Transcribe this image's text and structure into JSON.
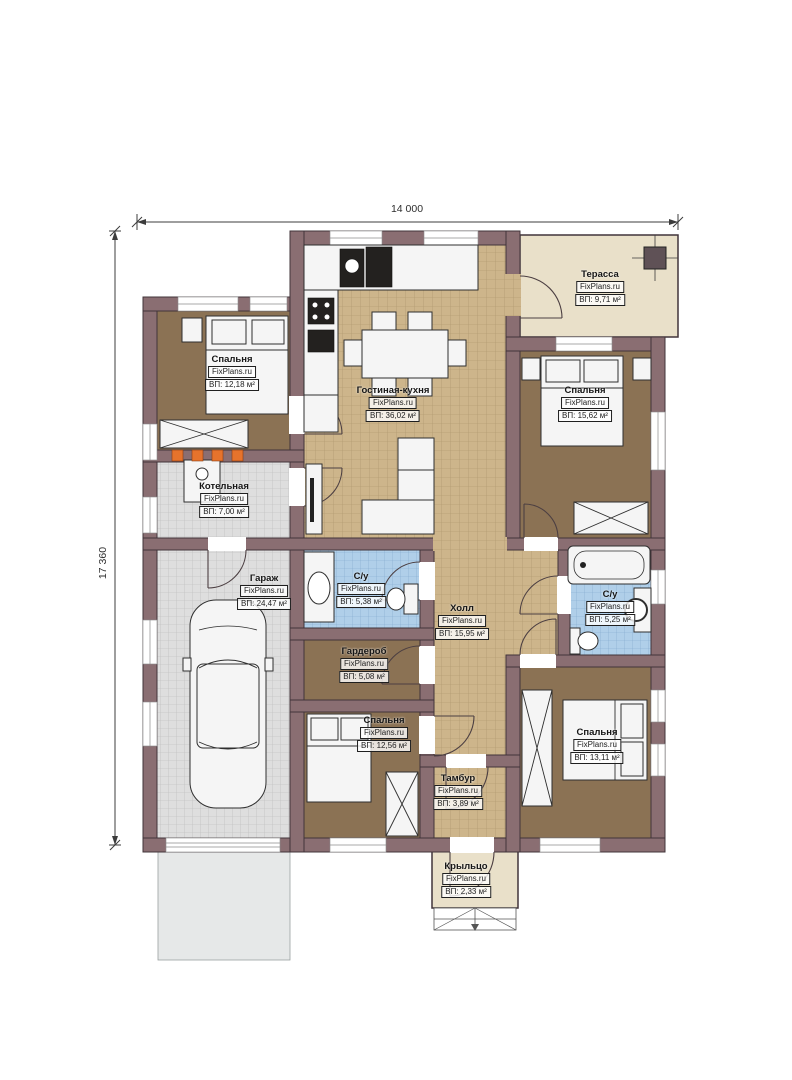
{
  "plan_title": "Одноэтажный дом — план этажа",
  "brand": "FixPlans.ru",
  "dimensions": {
    "width": "14 000",
    "height": "17 360"
  },
  "rooms": [
    {
      "name": "Спальня",
      "area": "ВП: 12,18 м²"
    },
    {
      "name": "Гостиная-кухня",
      "area": "ВП: 36,02 м²"
    },
    {
      "name": "Терасса",
      "area": "ВП: 9,71 м²"
    },
    {
      "name": "Спальня",
      "area": "ВП: 15,62 м²"
    },
    {
      "name": "Котельная",
      "area": "ВП: 7,00 м²"
    },
    {
      "name": "Гараж",
      "area": "ВП: 24,47 м²"
    },
    {
      "name": "С/у",
      "area": "ВП: 5,38 м²"
    },
    {
      "name": "Холл",
      "area": "ВП: 15,95 м²"
    },
    {
      "name": "С/у",
      "area": "ВП: 5,25 м²"
    },
    {
      "name": "Гардероб",
      "area": "ВП: 5,08 м²"
    },
    {
      "name": "Спальня",
      "area": "ВП: 12,56 м²"
    },
    {
      "name": "Спальня",
      "area": "ВП: 13,11 м²"
    },
    {
      "name": "Тамбур",
      "area": "ВП: 3,89 м²"
    },
    {
      "name": "Крыльцо",
      "area": "ВП: 2,33 м²"
    }
  ],
  "colors": {
    "wall": "#8a6e72",
    "wall_stroke": "#41343a",
    "floor_bedroom": "#8b7254",
    "tile_tan": "#cdb58b",
    "tile_tan_line": "#a9936a",
    "tile_blue": "#b0cfe9",
    "tile_blue_line": "#7fa8cc",
    "tile_gray": "#dedede",
    "tile_gray_line": "#b8b8b8",
    "terrace": "#e9e0c9",
    "driveway": "#e6e8e8",
    "furn": "#f5f5f5",
    "furn_stroke": "#2f2f2f",
    "accent_orange": "#e6732c"
  }
}
